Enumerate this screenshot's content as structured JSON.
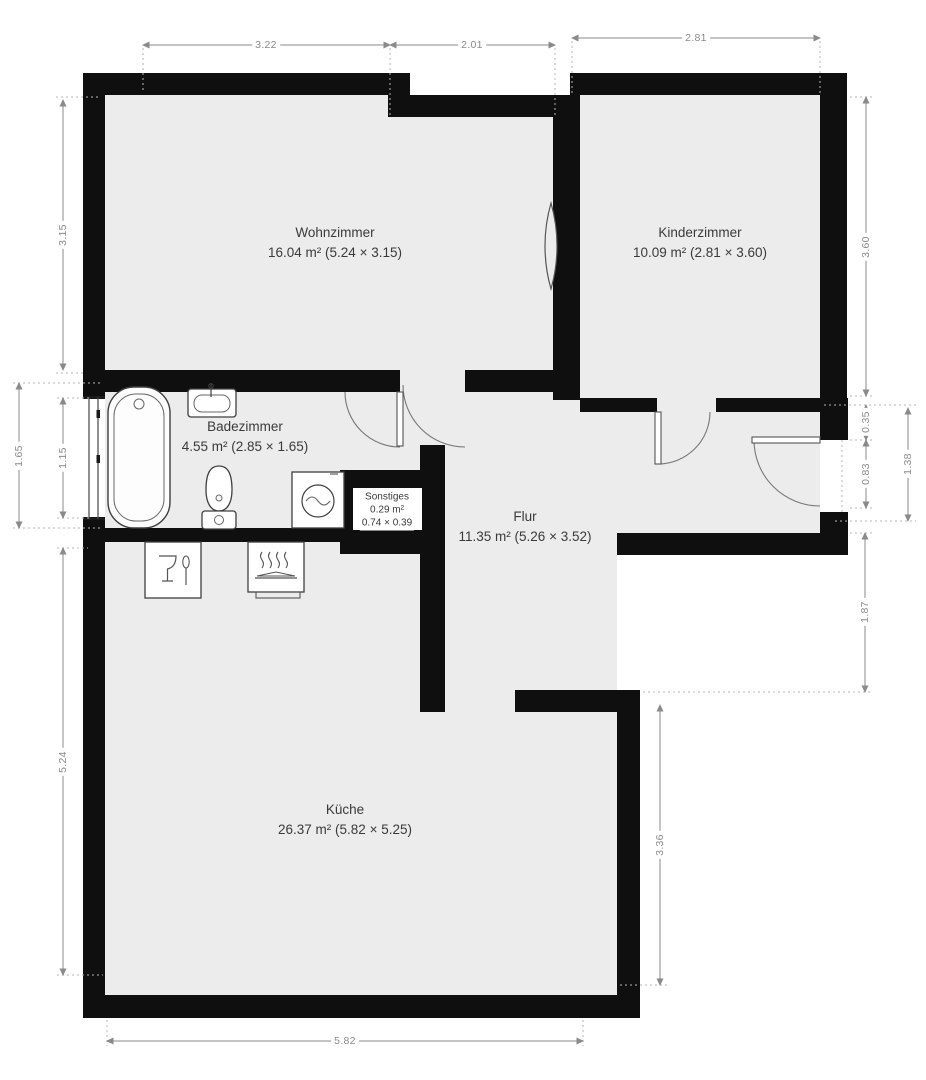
{
  "title": "Apartment floor plan",
  "colors": {
    "wall": "#0f0f0f",
    "floor": "#ececec",
    "dimension_line": "#8a8a8a",
    "extension_line": "#b5b5b5",
    "room_label": "#3a3a3a",
    "background": "#ffffff"
  },
  "rooms": [
    {
      "id": "wohnzimmer",
      "name": "Wohnzimmer",
      "size": "16.04 m² (5.24 × 3.15)"
    },
    {
      "id": "kinderzimmer",
      "name": "Kinderzimmer",
      "size": "10.09 m² (2.81 × 3.60)"
    },
    {
      "id": "badezimmer",
      "name": "Badezimmer",
      "size": "4.55 m² (2.85 × 1.65)"
    },
    {
      "id": "sonstiges",
      "name": "Sonstiges",
      "area": "0.29 m²",
      "size": "0.74 × 0.39"
    },
    {
      "id": "flur",
      "name": "Flur",
      "size": "11.35 m² (5.26 × 3.52)"
    },
    {
      "id": "kueche",
      "name": "Küche",
      "size": "26.37 m² (5.82 × 5.25)"
    }
  ],
  "dimensions": [
    {
      "label": "3.22"
    },
    {
      "label": "2.01"
    },
    {
      "label": "2.81"
    },
    {
      "label": "3.15"
    },
    {
      "label": "1.65"
    },
    {
      "label": "1.15"
    },
    {
      "label": "5.24"
    },
    {
      "label": "3.60"
    },
    {
      "label": "0.35"
    },
    {
      "label": "0.83"
    },
    {
      "label": "1.38"
    },
    {
      "label": "1.87"
    },
    {
      "label": "3.36"
    },
    {
      "label": "5.82"
    }
  ],
  "fixtures": [
    {
      "name": "bathtub"
    },
    {
      "name": "washbasin"
    },
    {
      "name": "toilet"
    },
    {
      "name": "washing-machine"
    },
    {
      "name": "dishwasher"
    },
    {
      "name": "stove"
    }
  ],
  "features": [
    {
      "name": "window"
    },
    {
      "name": "door-badezimmer"
    },
    {
      "name": "door-kinderzimmer"
    },
    {
      "name": "door-entry"
    },
    {
      "name": "wall-niche"
    }
  ]
}
